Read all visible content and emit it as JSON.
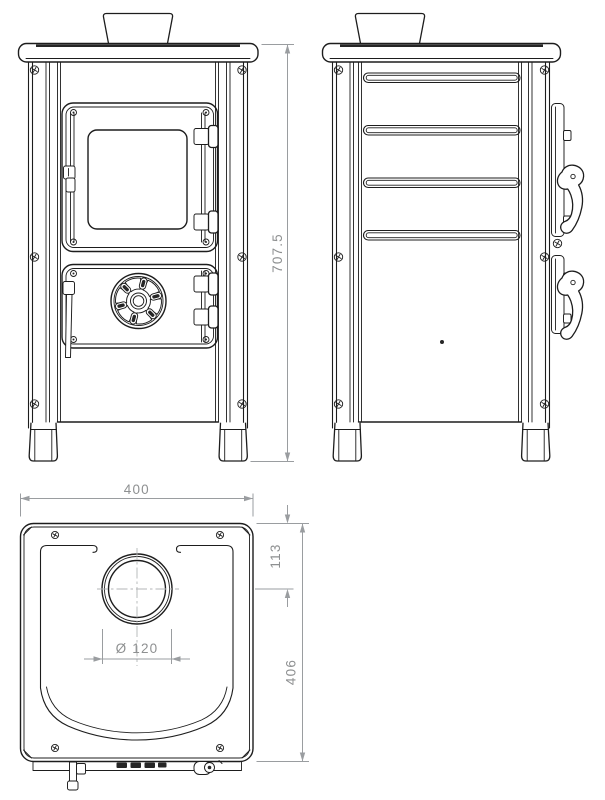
{
  "colors": {
    "background": "#ffffff",
    "line": "#1d1d1d",
    "dimension": "#8e9091"
  },
  "dimensions": {
    "overall_height": "707.5",
    "overall_width": "400",
    "flue_center_offset": "113",
    "overall_depth": "406",
    "flue_diameter": "Ø 120"
  }
}
